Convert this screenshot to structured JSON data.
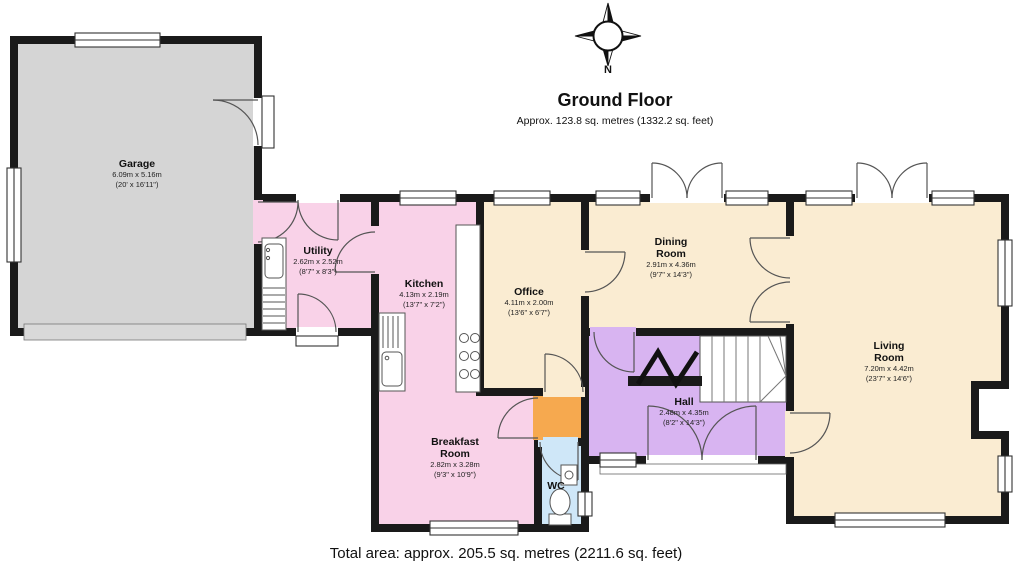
{
  "header": {
    "title": "Ground Floor",
    "subtitle": "Approx. 123.8 sq. metres (1332.2 sq. feet)"
  },
  "footer": {
    "total_area": "Total area: approx. 205.5 sq. metres (2211.6 sq. feet)"
  },
  "compass": {
    "north_label": "N"
  },
  "rooms": [
    {
      "name": "Garage",
      "metric": "6.09m x 5.16m",
      "imperial": "(20' x 16'11\")"
    },
    {
      "name": "Utility",
      "metric": "2.62m x 2.52m",
      "imperial": "(8'7\" x 8'3\")"
    },
    {
      "name": "Kitchen",
      "metric": "4.13m x 2.19m",
      "imperial": "(13'7\" x 7'2\")"
    },
    {
      "name": "Office",
      "metric": "4.11m x 2.00m",
      "imperial": "(13'6\" x 6'7\")"
    },
    {
      "name": "Dining Room",
      "metric": "2.91m x 4.36m",
      "imperial": "(9'7\" x 14'3\")"
    },
    {
      "name": "Living Room",
      "metric": "7.20m x 4.42m",
      "imperial": "(23'7\" x 14'6\")"
    },
    {
      "name": "Hall",
      "metric": "2.48m x 4.35m",
      "imperial": "(8'2\" x 14'3\")"
    },
    {
      "name": "Breakfast Room",
      "metric": "2.82m x 3.28m",
      "imperial": "(9'3\" x 10'9\")"
    },
    {
      "name": "WC",
      "metric": "",
      "imperial": ""
    }
  ],
  "colors": {
    "garage_gray": "#d5d5d5",
    "room_pink": "#f9d2e8",
    "room_cream": "#faecd2",
    "hall_purple": "#d8b4f1",
    "wc_blue": "#cfe7f8",
    "lobby_orange": "#f6a94f",
    "wall": "#1a1a1a"
  }
}
